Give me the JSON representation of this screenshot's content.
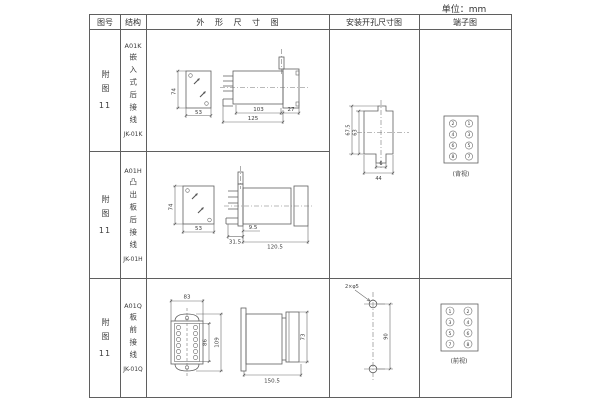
{
  "unit_label": "单位：mm",
  "header": {
    "figure": "图号",
    "structure": "结构",
    "outline": "外 形 尺 寸 图",
    "mounting": "安装开孔尺寸图",
    "terminal": "端子图"
  },
  "rows": [
    {
      "figure": "附图",
      "figure_num": "11",
      "model": "A01K",
      "structure": "嵌入式后接线",
      "code": "JK-01K",
      "dims": {
        "h": "74",
        "w": "53",
        "body": "103",
        "flange": "27",
        "total": "125"
      }
    },
    {
      "figure": "附图",
      "figure_num": "11",
      "model": "A01H",
      "structure": "凸出板后接线",
      "code": "JK-01H",
      "dims": {
        "h": "74",
        "w": "53",
        "front": "31.5",
        "inset": "9.5",
        "total": "120.5"
      }
    },
    {
      "figure": "附图",
      "figure_num": "11",
      "model": "A01Q",
      "structure": "板前接线",
      "code": "JK-01Q",
      "dims": {
        "w": "83",
        "inner_h": "86",
        "outer_h": "109",
        "side_h": "73",
        "depth": "150.5"
      }
    }
  ],
  "mounting_kh": {
    "outer": "67.5",
    "inner": "63",
    "notch": "6",
    "width": "44"
  },
  "mounting_q": {
    "holes": "2×φ5",
    "pitch": "90"
  },
  "terminal_rear": {
    "label": "(背视)",
    "left": [
      "2",
      "4",
      "6",
      "8"
    ],
    "right": [
      "1",
      "3",
      "5",
      "7"
    ]
  },
  "terminal_front": {
    "label": "(前视)",
    "left": [
      "1",
      "3",
      "5",
      "7"
    ],
    "right": [
      "2",
      "4",
      "6",
      "8"
    ]
  }
}
